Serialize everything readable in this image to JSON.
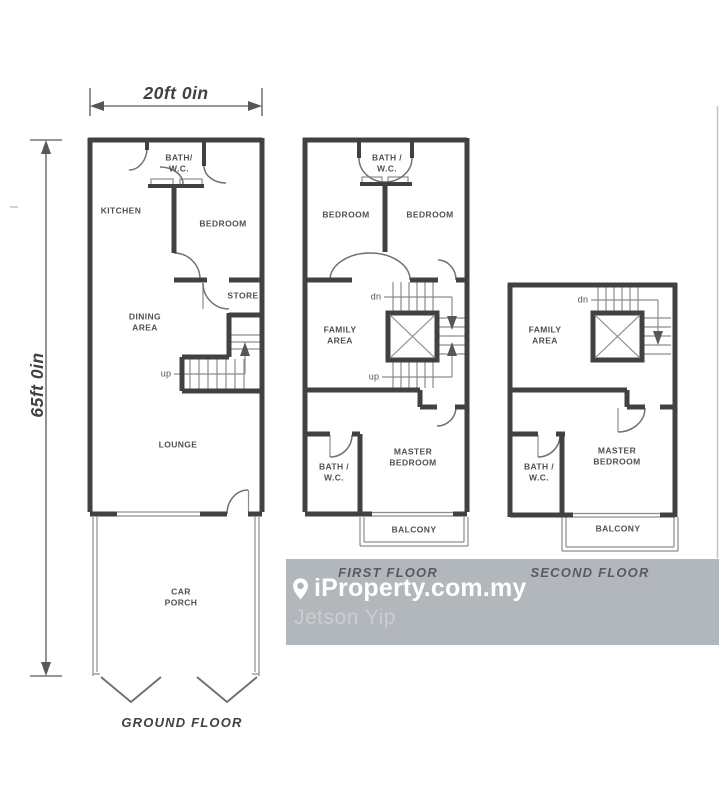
{
  "dimensions": {
    "width_label": "20ft 0in",
    "height_label": "65ft 0in"
  },
  "floors": {
    "ground": {
      "title": "GROUND FLOOR",
      "rooms": {
        "bath": "BATH/\nW.C.",
        "kitchen": "KITCHEN",
        "bedroom": "BEDROOM",
        "store": "STORE",
        "dining": "DINING\nAREA",
        "up_label": "up",
        "lounge": "LOUNGE",
        "car_porch": "CAR\nPORCH"
      }
    },
    "first": {
      "title": "FIRST FLOOR",
      "rooms": {
        "bath_top": "BATH /\nW.C.",
        "bedroom_left": "BEDROOM",
        "bedroom_right": "BEDROOM",
        "dn_label": "dn",
        "family": "FAMILY\nAREA",
        "up_label": "up",
        "bath_bottom": "BATH /\nW.C.",
        "master": "MASTER\nBEDROOM",
        "balcony": "BALCONY"
      }
    },
    "second": {
      "title": "SECOND FLOOR",
      "rooms": {
        "dn_label": "dn",
        "family": "FAMILY\nAREA",
        "bath": "BATH /\nW.C.",
        "master": "MASTER\nBEDROOM",
        "balcony": "BALCONY"
      }
    }
  },
  "watermark": {
    "brand": "iProperty.com.my",
    "agent": "Jetson Yip",
    "band_color": "#acb2b7",
    "brand_color": "#ffffff",
    "agent_color": "#c9ced2"
  },
  "colors": {
    "wall": "#3f4245",
    "thin_line": "#85888b",
    "label": "#4e5154",
    "background": "#ffffff"
  }
}
